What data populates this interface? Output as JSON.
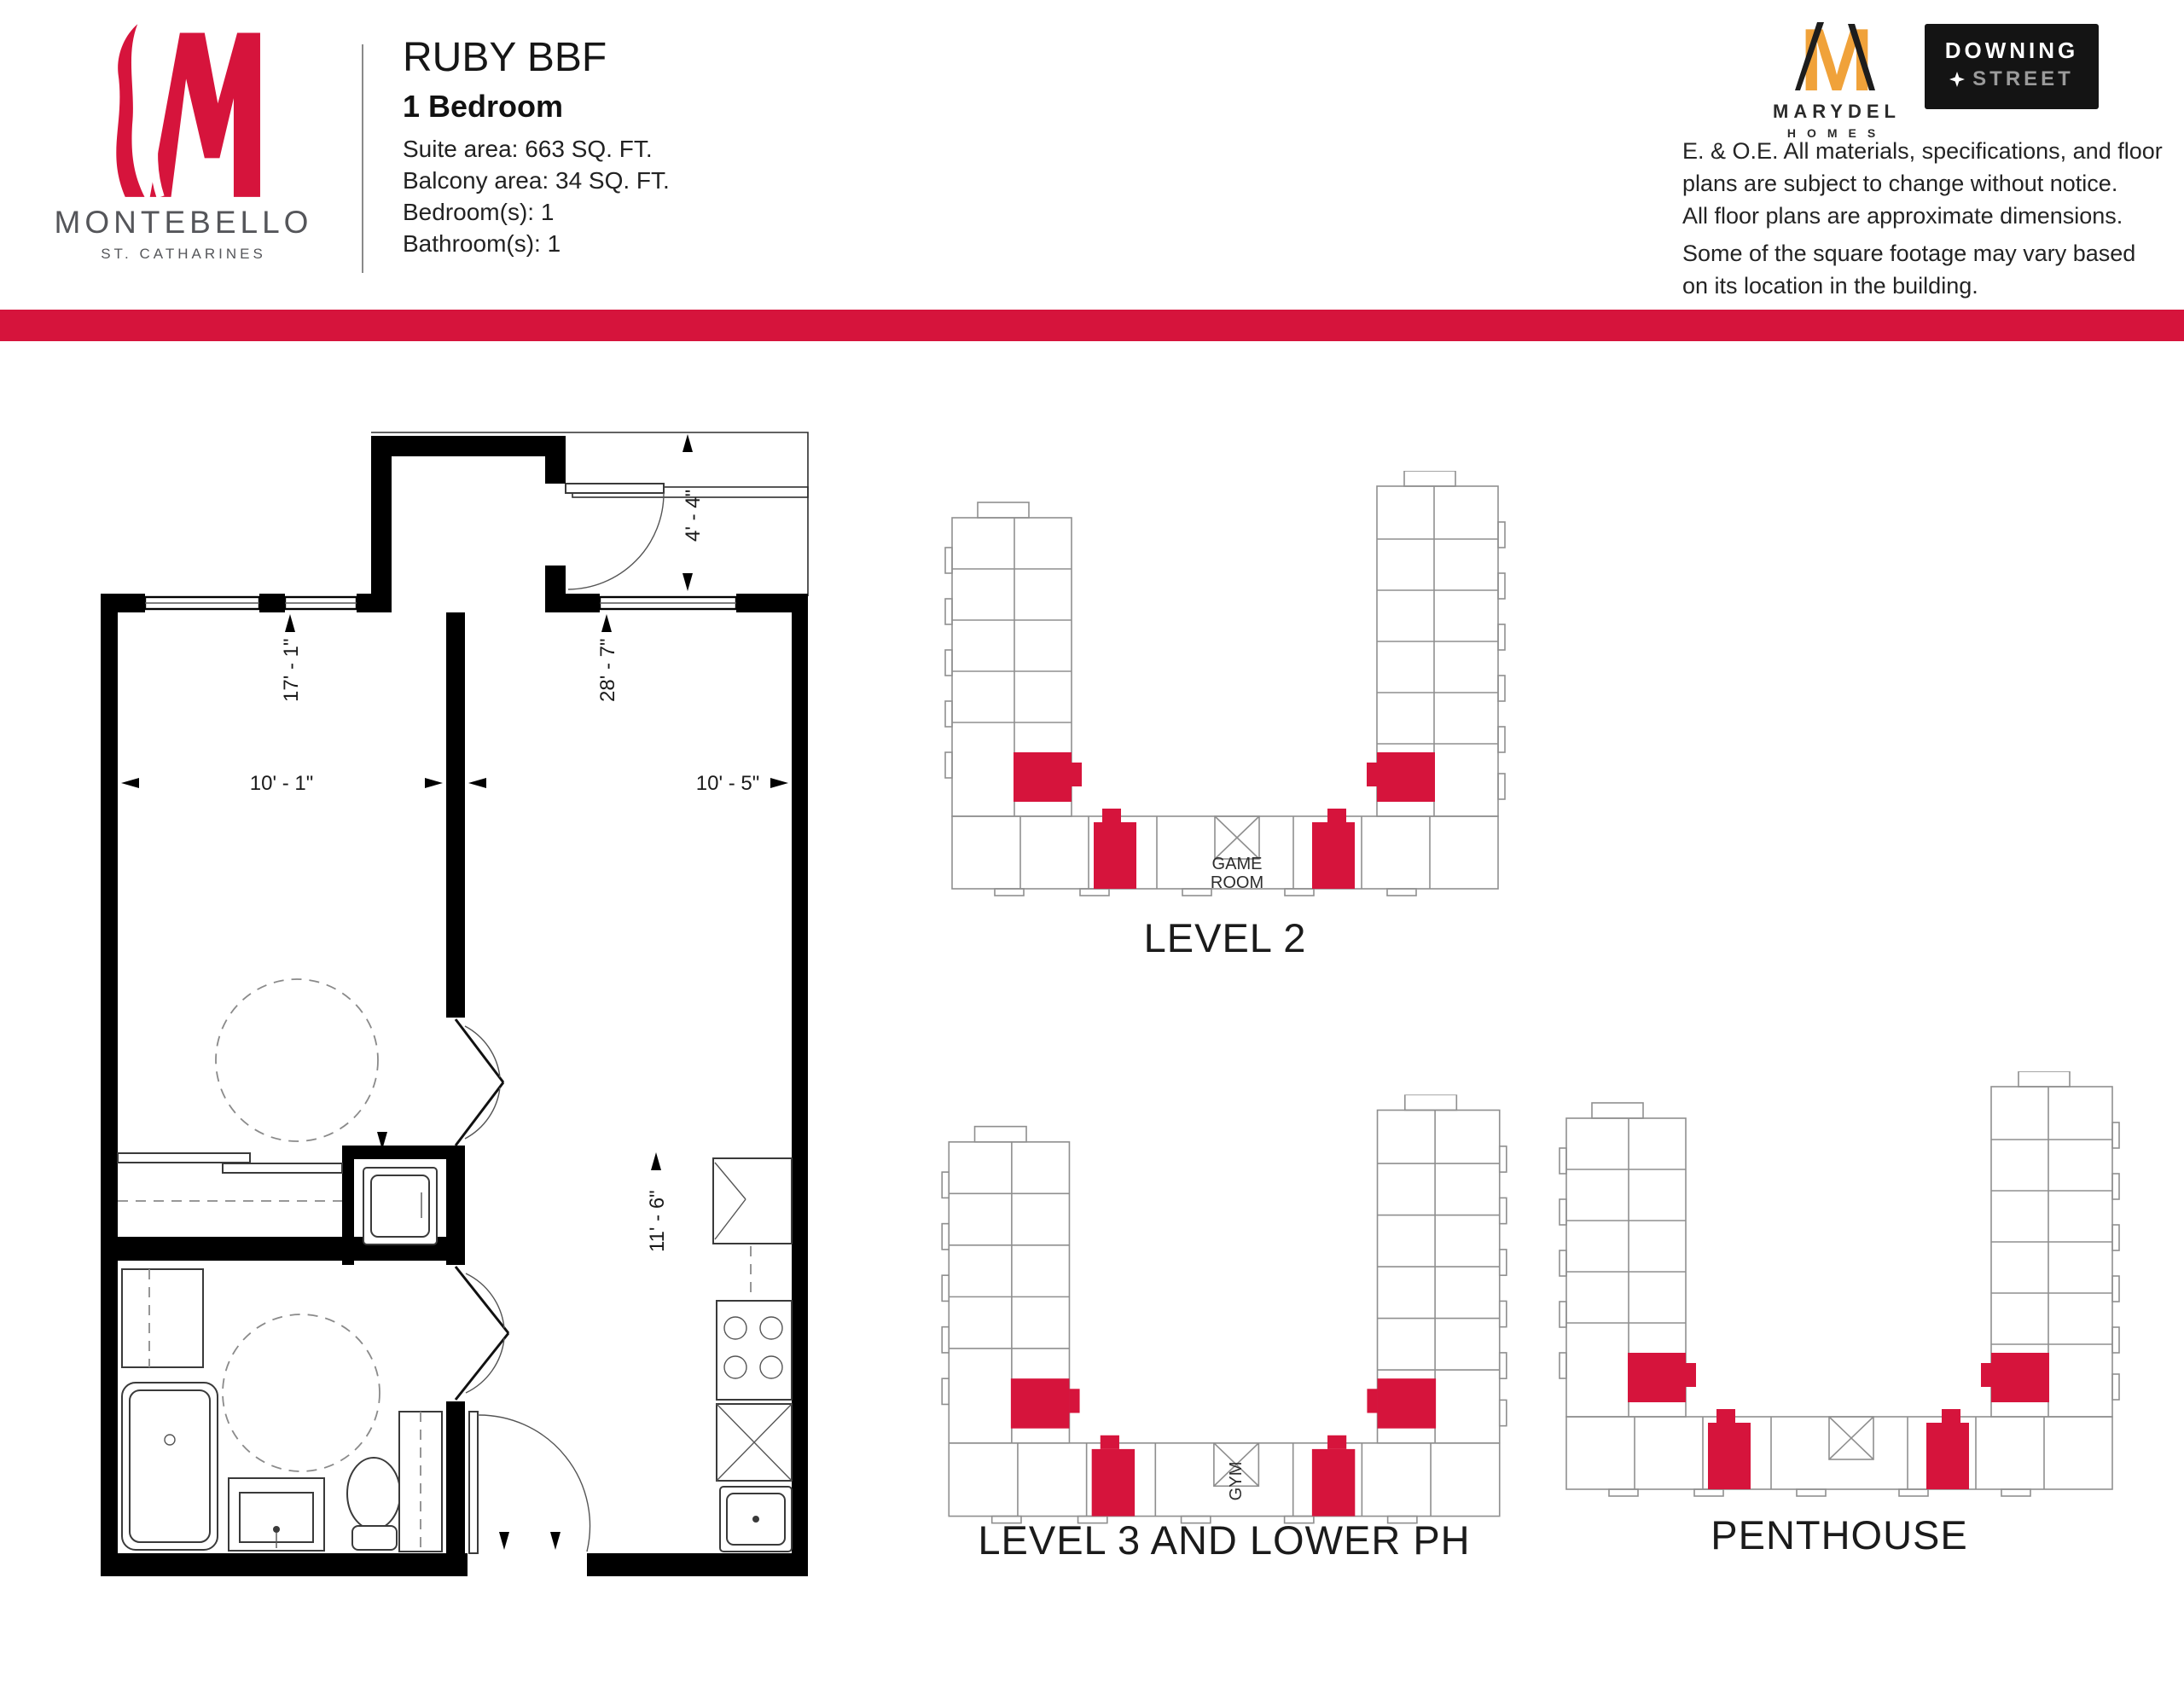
{
  "header": {
    "project": {
      "name": "MONTEBELLO",
      "location": "ST. CATHARINES"
    },
    "plan": {
      "title": "RUBY BBF",
      "subtitle": "1 Bedroom",
      "details": [
        "Suite area: 663 SQ. FT.",
        "Balcony area: 34 SQ. FT.",
        "Bedroom(s): 1",
        "Bathroom(s): 1"
      ]
    },
    "brands": {
      "marydel_name": "MARYDEL",
      "marydel_sub": "HOMES",
      "downing_line1": "DOWNING",
      "downing_line2": "STREET"
    },
    "disclaimer_1": "E. & O.E.  All materials, specifications, and floor\nplans are subject to change without notice.\nAll floor plans are approximate dimensions.",
    "disclaimer_2": "Some of the square footage may vary based\non its location in the building."
  },
  "floor_plan": {
    "dimensions": {
      "balcony_depth": "4' - 4\"",
      "bedroom_length": "17' - 1\"",
      "suite_length": "28' - 7\"",
      "bedroom_width": "10' - 1\"",
      "living_width": "10' - 5\"",
      "kitchen_length": "11' - 6\""
    }
  },
  "key_plans": [
    {
      "caption": "LEVEL 2",
      "center_label_1": "GAME",
      "center_label_2": "ROOM"
    },
    {
      "caption": "LEVEL 3 AND LOWER PH",
      "center_label": "GYM"
    },
    {
      "caption": "PENTHOUSE"
    }
  ],
  "colors": {
    "accent_red": "#D6143C",
    "marydel_orange": "#F0A23A"
  }
}
